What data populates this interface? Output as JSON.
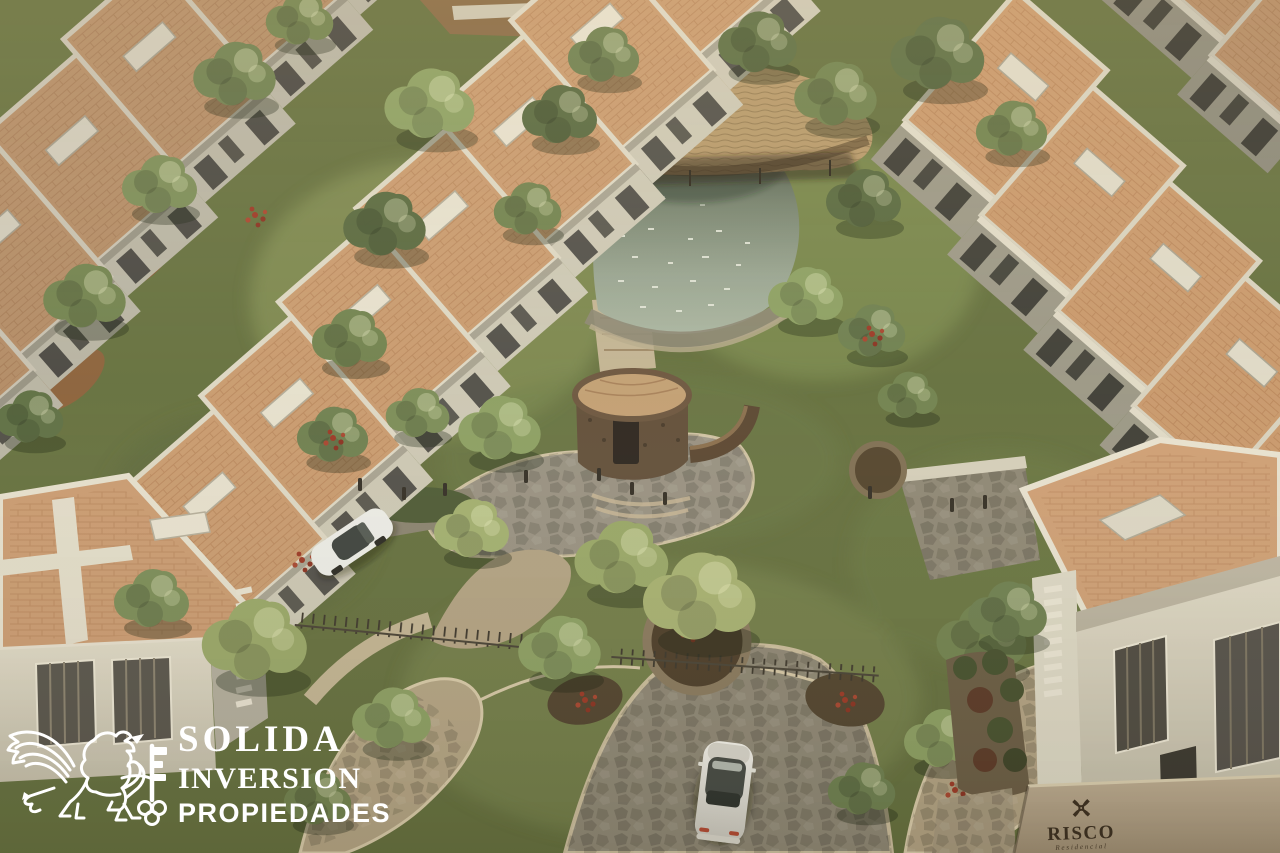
{
  "image": {
    "type": "aerial-architectural-render",
    "description": "Aerial 3D render of a residential community: staggered rows of flat-roofed townhomes with terracotta roof decks flanking a central landscaped park with a pond, thatched palapa, round stone pavilion, winding flagstone paths, a cobbled drive with a white car, a parked white car, and project signage on a perimeter wall"
  },
  "watermark": {
    "line1": "SOLIDA",
    "line2": "INVERSION",
    "line3": "PROPIEDADES",
    "logo": "winged-lion-and-key",
    "color": "#ffffff"
  },
  "signage": {
    "name": "RISCO",
    "subtitle": "Residencial",
    "emblem": "floral-x-monogram",
    "text_color": "#3d3020",
    "wall_color": "#b3a287"
  },
  "palette": {
    "roof_terracotta": "#c99b6f",
    "wall_light": "#ddd7c3",
    "wall_shadow": "#9c9886",
    "vegetation_dark": "#5a6a40",
    "vegetation_mid": "#72834f",
    "vegetation_light": "#a3b070",
    "water": "#8a968a",
    "path_tan": "#b5a584",
    "cobble_gray": "#8f8875",
    "stone_dark": "#63503a",
    "soil": "#96603c",
    "car_white": "#ecece6"
  },
  "scene": {
    "elements": [
      "left-townhouse-rows",
      "right-townhouse-rows",
      "corner-house-left",
      "corner-house-right",
      "central-park",
      "pond",
      "palapa",
      "stone-pavilion",
      "central-tree-planter",
      "flagstone-paths",
      "cobble-drive",
      "metal-fence",
      "bollards",
      "white-car-driving",
      "white-car-parked",
      "perimeter-sign-wall"
    ]
  }
}
